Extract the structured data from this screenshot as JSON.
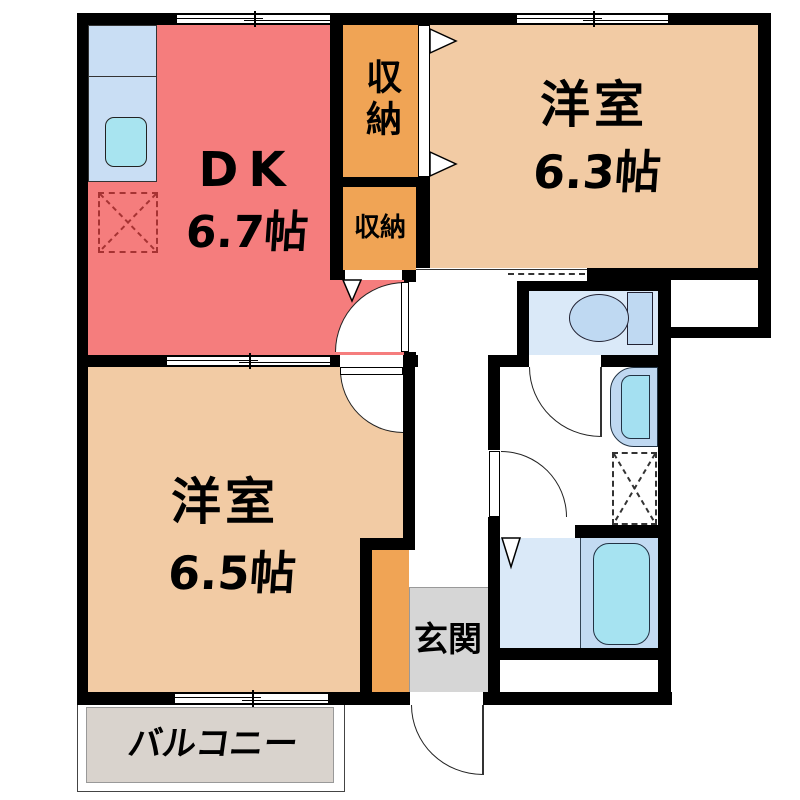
{
  "rooms": {
    "dk": {
      "name": "DK",
      "size": "6.7帖"
    },
    "western_room_upper": {
      "name": "洋室",
      "size": "6.3帖"
    },
    "western_room_lower": {
      "name": "洋室",
      "size": "6.5帖"
    },
    "storage_upper": {
      "name": "収納"
    },
    "storage_lower": {
      "name": "収納"
    },
    "entrance": {
      "name": "玄関"
    },
    "balcony": {
      "name": "バルコニー"
    }
  },
  "colors": {
    "dk_floor": "#F57D7D",
    "western_room_floor": "#F2CBA4",
    "storage_floor": "#F0A455",
    "corridor_floor": "#F0A455",
    "entrance_floor": "#D6D6D6",
    "wet_room_floor": "#DAE9F8",
    "bath_floor": "#C3DBF2",
    "bathtub": "#A6E3F1",
    "kitchen_counter": "#C9DEF4",
    "kitchen_sink": "#A8E4F0",
    "balcony_floor": "#D9D3CD",
    "wall": "#000000",
    "refrigerator_mark": "#A63333"
  }
}
